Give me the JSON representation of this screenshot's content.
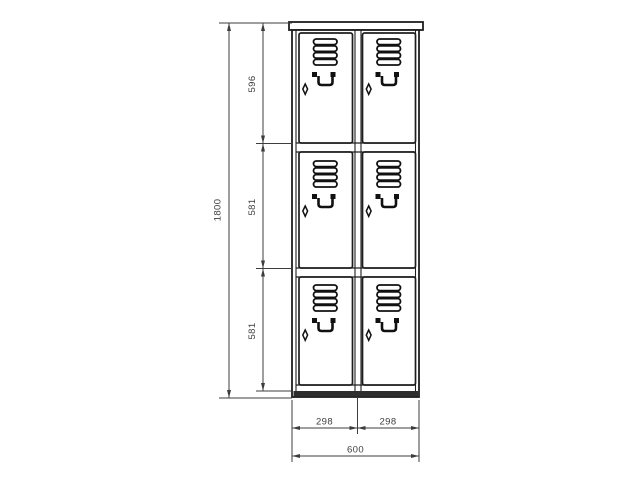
{
  "drawing": {
    "type": "locker-cabinet-front-elevation",
    "units_implied": "mm"
  },
  "locker": {
    "columns": 2,
    "rows": 3,
    "doors": 6,
    "door_features": [
      "vent-louvers",
      "recessed-handle",
      "keyhole-lock"
    ]
  },
  "dimensions": {
    "total_height": "1800",
    "section_heights": [
      "596",
      "581",
      "581"
    ],
    "door_widths": [
      "298",
      "298"
    ],
    "total_width": "600"
  },
  "icons": {
    "vent": "louver-slats",
    "handle": "recessed-pull-handle",
    "lock": "diamond-keyhole"
  },
  "colors": {
    "background": "#ffffff",
    "drawing_outline": "#1e1e1e",
    "dimension_lines": "#3d3d3d",
    "base_fill": "#2e2e2e"
  }
}
